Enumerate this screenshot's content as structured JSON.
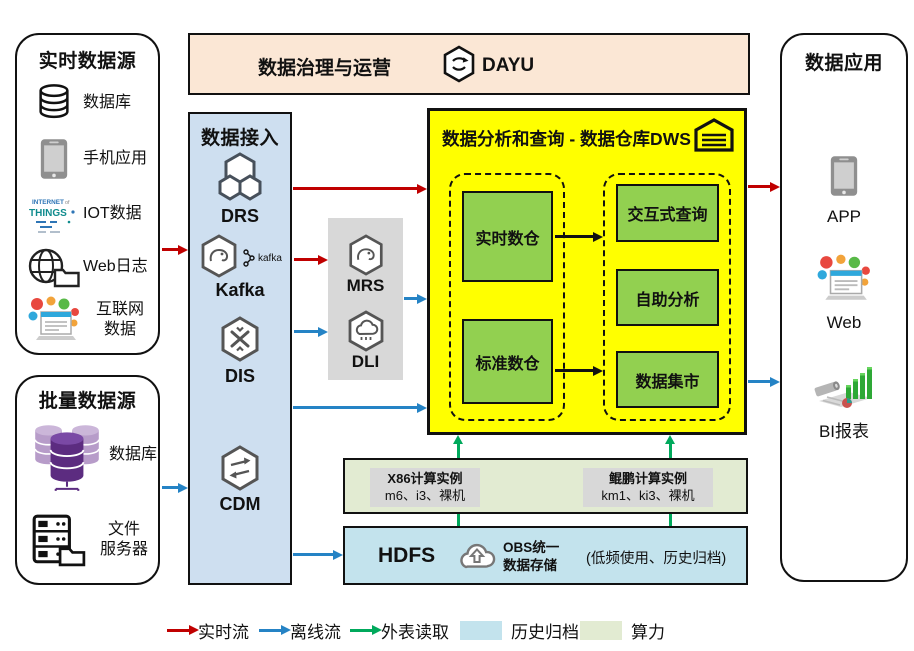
{
  "colors": {
    "realtime_flow": "#C00000",
    "offline_flow": "#2583C5",
    "external_read": "#00A95C",
    "history_archive": "#C3E3ED",
    "compute_power": "#E2EBD2",
    "dws_bg": "#FFFF00",
    "warehouse_green": "#92D050",
    "ingestion_bg": "#CEDFF0",
    "governance_bg": "#FBE7D5",
    "middleware_bg": "#D8D8D8"
  },
  "realtime_sources": {
    "title": "实时数据源",
    "items": [
      {
        "label": "数据库"
      },
      {
        "label": "手机应用"
      },
      {
        "label": "IOT数据"
      },
      {
        "label": "Web日志"
      },
      {
        "label": "互联网\n数据"
      }
    ]
  },
  "batch_sources": {
    "title": "批量数据源",
    "items": [
      {
        "label": "数据库"
      },
      {
        "label": "文件\n服务器"
      }
    ]
  },
  "ingestion": {
    "title": "数据接入",
    "services": [
      {
        "name": "DRS"
      },
      {
        "name": "Kafka",
        "badge": "kafka"
      },
      {
        "name": "DIS"
      },
      {
        "name": "CDM"
      }
    ]
  },
  "governance": {
    "title": "数据治理与运营",
    "product": "DAYU"
  },
  "dws": {
    "title": "数据分析和查询 - 数据仓库DWS",
    "warehouses": [
      "实时数仓",
      "标准数仓"
    ],
    "services": [
      "交互式查询",
      "自助分析",
      "数据集市"
    ]
  },
  "middleware": {
    "services": [
      "MRS",
      "DLI"
    ]
  },
  "compute": {
    "instances": [
      {
        "title": "X86计算实例",
        "detail": "m6、i3、裸机"
      },
      {
        "title": "鲲鹏计算实例",
        "detail": "km1、ki3、裸机"
      }
    ]
  },
  "storage": {
    "hdfs": "HDFS",
    "obs": "OBS统一\n数据存储",
    "note": "(低频使用、历史归档)"
  },
  "applications": {
    "title": "数据应用",
    "items": [
      {
        "label": "APP"
      },
      {
        "label": "Web"
      },
      {
        "label": "BI报表"
      }
    ]
  },
  "legend": {
    "items": [
      {
        "label": "实时流",
        "type": "arrow"
      },
      {
        "label": "离线流",
        "type": "arrow"
      },
      {
        "label": "外表读取",
        "type": "arrow"
      },
      {
        "label": "历史归档",
        "type": "swatch"
      },
      {
        "label": "算力",
        "type": "swatch"
      }
    ]
  }
}
